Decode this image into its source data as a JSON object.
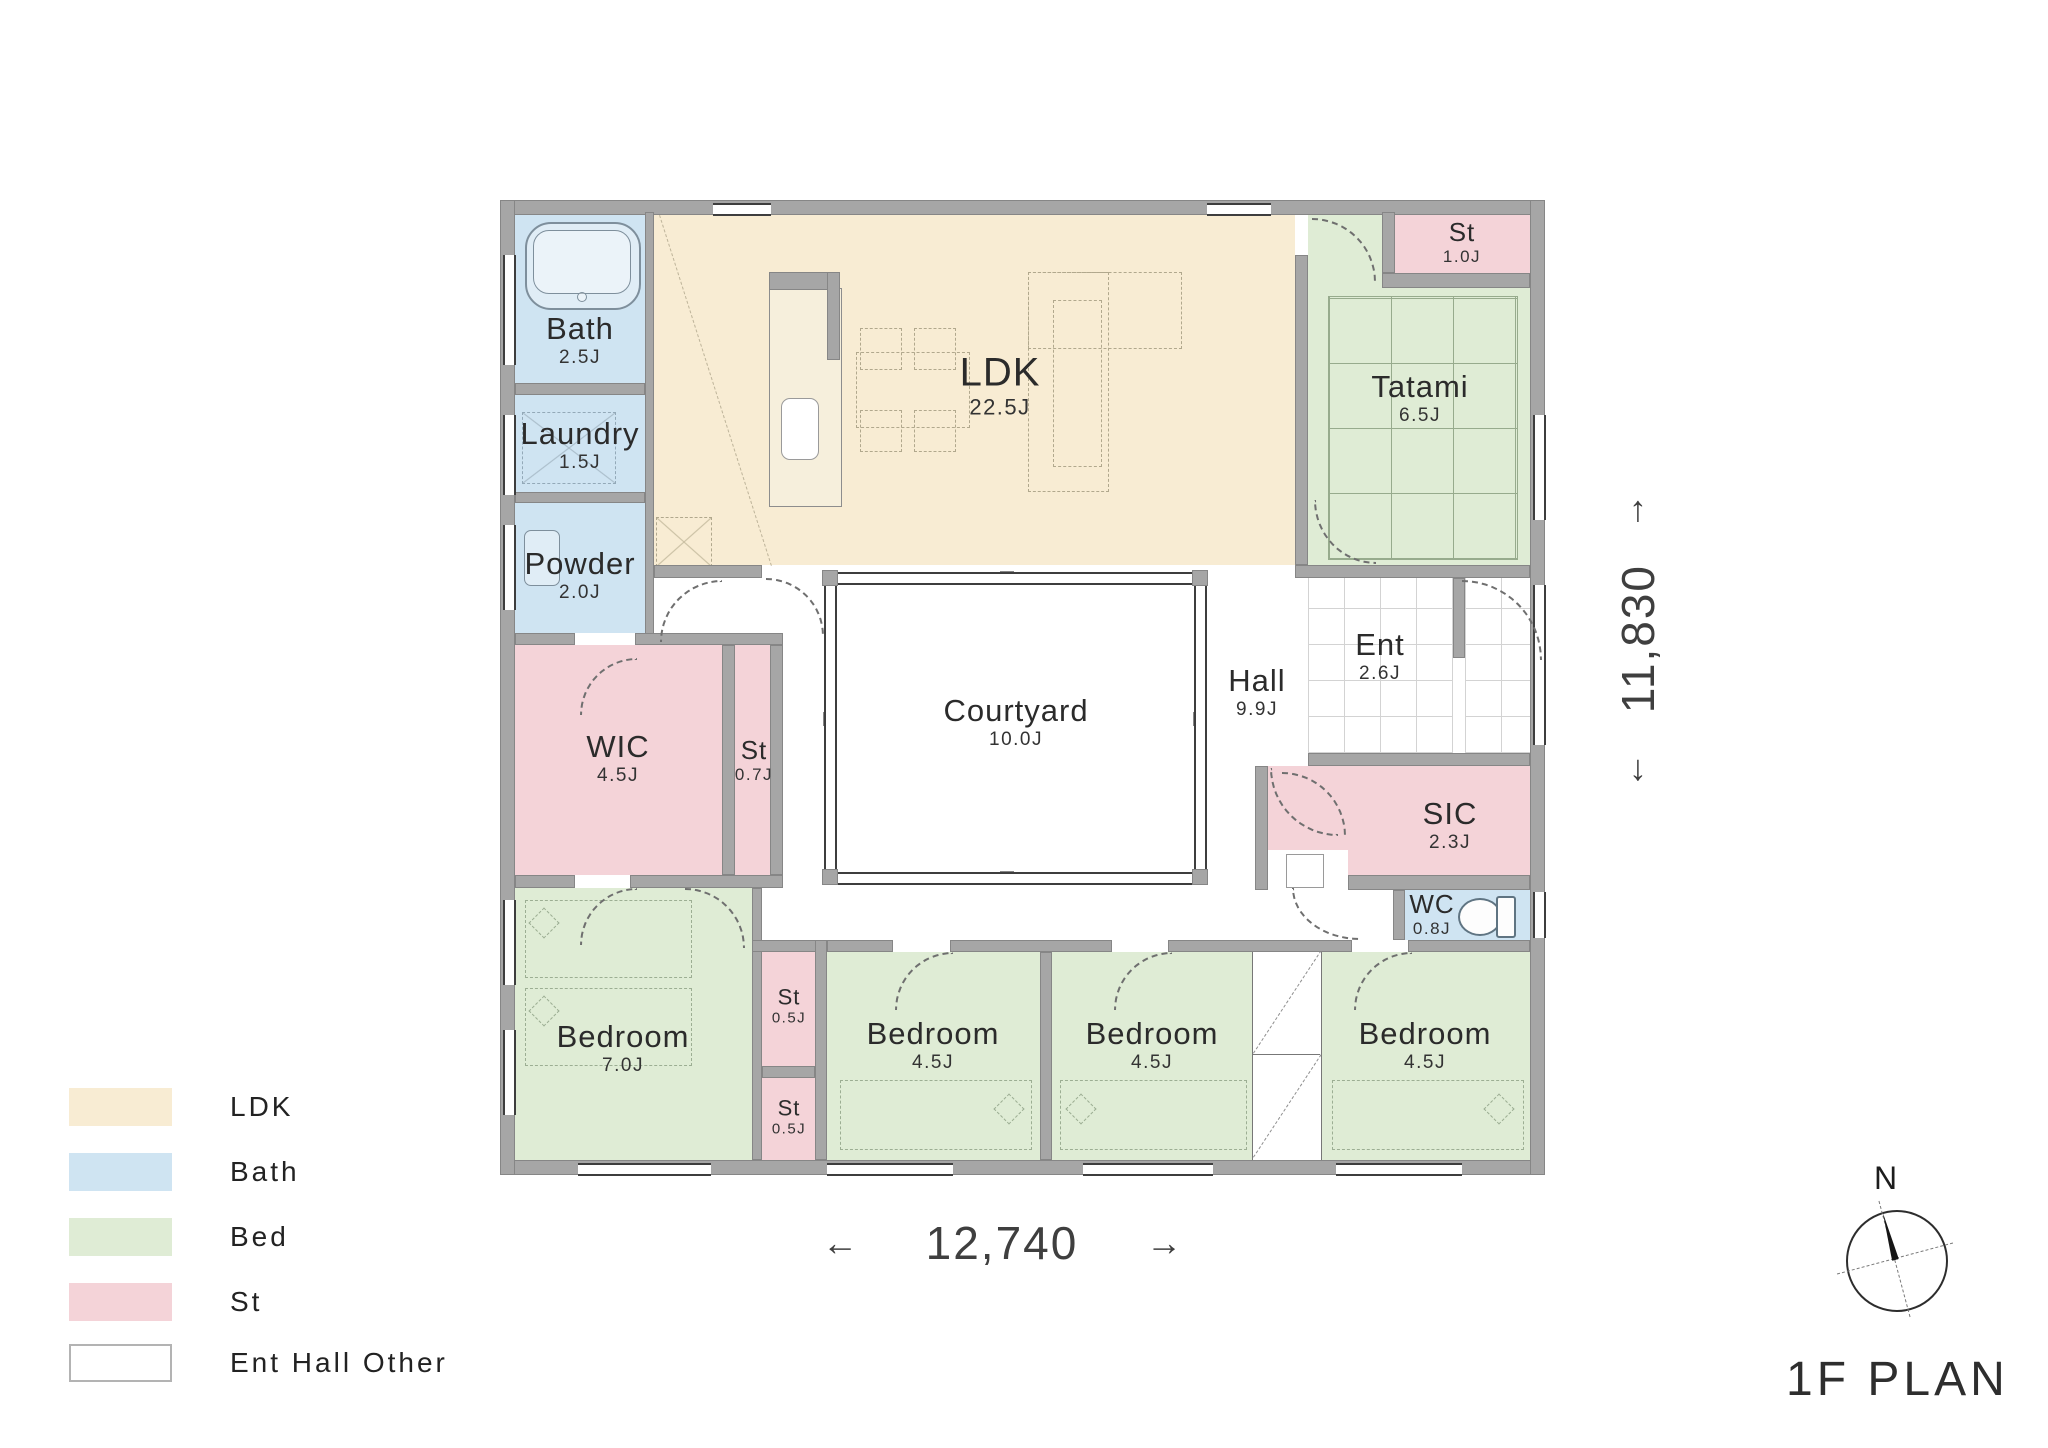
{
  "page": {
    "title": "1F PLAN",
    "compass": "N"
  },
  "legend": {
    "items": [
      {
        "label": "LDK",
        "color": "#f8ecd3"
      },
      {
        "label": "Bath",
        "color": "#cfe4f2"
      },
      {
        "label": "Bed",
        "color": "#dfecd5"
      },
      {
        "label": "St",
        "color": "#f4d3d8"
      },
      {
        "label": "Ent  Hall  Other",
        "color": "#ffffff"
      }
    ]
  },
  "dimensions": {
    "width_mm": "12,740",
    "height_mm": "11,830",
    "arrow_left": "←",
    "arrow_right": "→",
    "arrow_up": "↑",
    "arrow_down": "↓"
  },
  "rooms": {
    "bath": {
      "name": "Bath",
      "area": "2.5J"
    },
    "laundry": {
      "name": "Laundry",
      "area": "1.5J"
    },
    "powder": {
      "name": "Powder",
      "area": "2.0J"
    },
    "ldk": {
      "name": "LDK",
      "area": "22.5J"
    },
    "st_top": {
      "name": "St",
      "area": "1.0J"
    },
    "tatami": {
      "name": "Tatami",
      "area": "6.5J"
    },
    "courtyard": {
      "name": "Courtyard",
      "area": "10.0J"
    },
    "hall": {
      "name": "Hall",
      "area": "9.9J"
    },
    "ent": {
      "name": "Ent",
      "area": "2.6J"
    },
    "wic": {
      "name": "WIC",
      "area": "4.5J"
    },
    "st_mid": {
      "name": "St",
      "area": "0.7J"
    },
    "sic": {
      "name": "SIC",
      "area": "2.3J"
    },
    "wc": {
      "name": "WC",
      "area": "0.8J"
    },
    "bedroom_main": {
      "name": "Bedroom",
      "area": "7.0J"
    },
    "st_small_upper": {
      "name": "St",
      "area": "0.5J"
    },
    "st_small_lower": {
      "name": "St",
      "area": "0.5J"
    },
    "bedroom_2": {
      "name": "Bedroom",
      "area": "4.5J"
    },
    "bedroom_3": {
      "name": "Bedroom",
      "area": "4.5J"
    },
    "bedroom_4": {
      "name": "Bedroom",
      "area": "4.5J"
    }
  }
}
